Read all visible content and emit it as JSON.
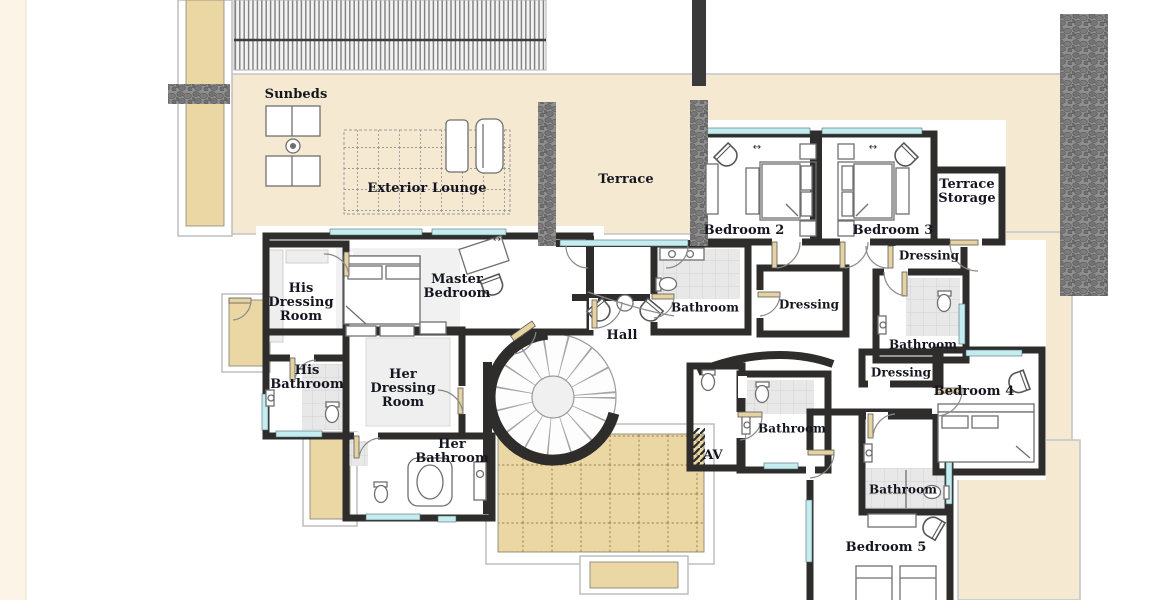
{
  "plan": {
    "title": "Villa upper floor plan",
    "labels": {
      "sunbeds": "Sunbeds",
      "exterior_lounge": "Exterior Lounge",
      "terrace": "Terrace",
      "terrace_storage": "Terrace\nStorage",
      "bedroom2": "Bedroom 2",
      "bedroom3": "Bedroom 3",
      "dressing_bedroom3": "Dressing",
      "bathroom_bedroom2": "Bathroom",
      "dressing_bedroom2": "Dressing",
      "hall": "Hall",
      "master_bedroom": "Master\nBedroom",
      "his_dressing_room": "His\nDressing\nRoom",
      "his_bathroom": "His\nBathroom",
      "her_dressing_room": "Her\nDressing\nRoom",
      "her_bathroom": "Her\nBathroom",
      "bathroom_bedroom3": "Bathroom",
      "dressing_bedroom4": "Dressing",
      "bedroom4": "Bedroom 4",
      "av": "AV",
      "bathroom_shared": "Bathroom",
      "bathroom_bedroom5": "Bathroom",
      "bedroom5": "Bedroom 5"
    },
    "window_arrow": "↔",
    "colors": {
      "terrace_cream": "#f5e9d2",
      "courtyard_tan": "#ead7a4",
      "wall_dark": "#2e2d2b",
      "glass_cyan": "#c5edf0",
      "stone_gray": "#8f8f8f",
      "tile_gray": "#e8e8e8",
      "door_leaf_tan": "#e7d3a2",
      "label_ink": "#15151f"
    }
  }
}
